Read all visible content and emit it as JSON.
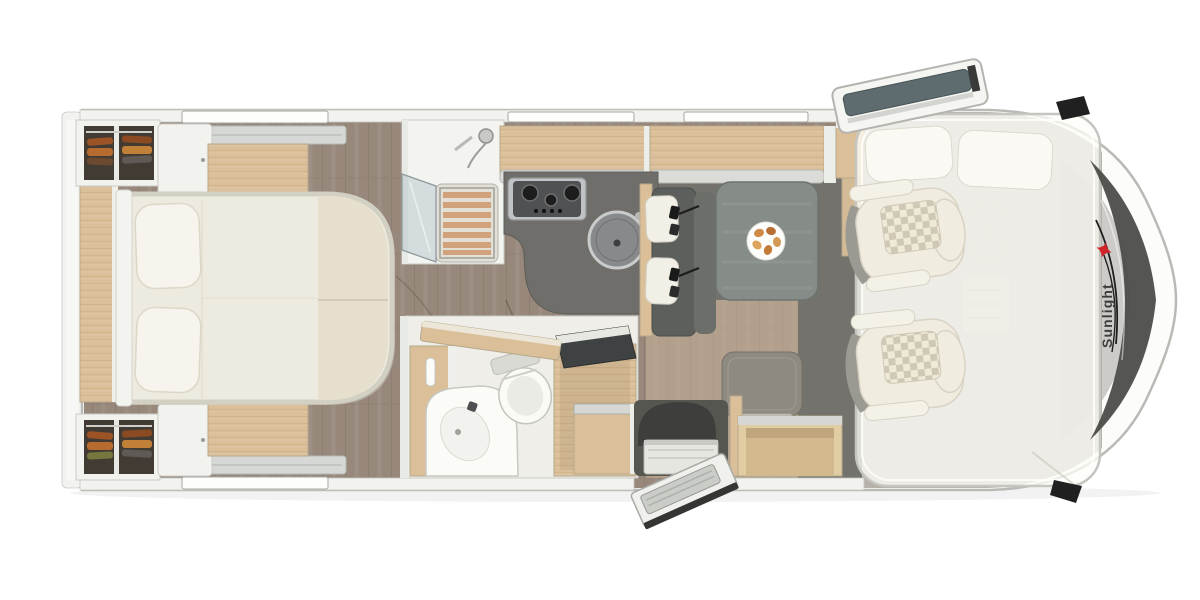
{
  "app": {
    "name": "Motorhome floor plan",
    "view": "top-down render"
  },
  "brand": {
    "logo_text": "Sunlight",
    "logo_icon": "sunlight-sun-icon"
  },
  "colors": {
    "pageBg": "#ffffff",
    "bodyFill": "#fcfcfa",
    "bodyOutline": "#b9bab6",
    "wallFill": "#f2f2ef",
    "wallLine": "#c6c7c3",
    "floorWood": "#97887b",
    "floorWoodLight": "#b3a08c",
    "floorDark": "#73726c",
    "wood": "#dabf98",
    "woodEdge": "#b5a88c",
    "bedIvory": "#edebdf",
    "bedBeige": "#e6dfcd",
    "counterGray": "#6f6e6a",
    "tableGray": "#868d89",
    "benchGray": "#5d5f5c",
    "seatCream": "#f1ece0",
    "seatBolsterGray": "#9b9a92",
    "checkerLight": "#efe9d8",
    "checkerDark": "#cfc8b4",
    "slatTerracotta": "#cf9d74",
    "stainless": "#c0c3c5",
    "applianceDark": "#4f5152",
    "glassTint": "#aebec3",
    "windshieldDark": "#4c4d49",
    "mirrorBlack": "#1f201f",
    "overlayWhite": "#fdfdf7",
    "brandRed": "#d1232a",
    "logoGray": "#3d3d3c",
    "clothesOrange": "#b86b2e",
    "clothesBrown": "#8a4a22"
  }
}
